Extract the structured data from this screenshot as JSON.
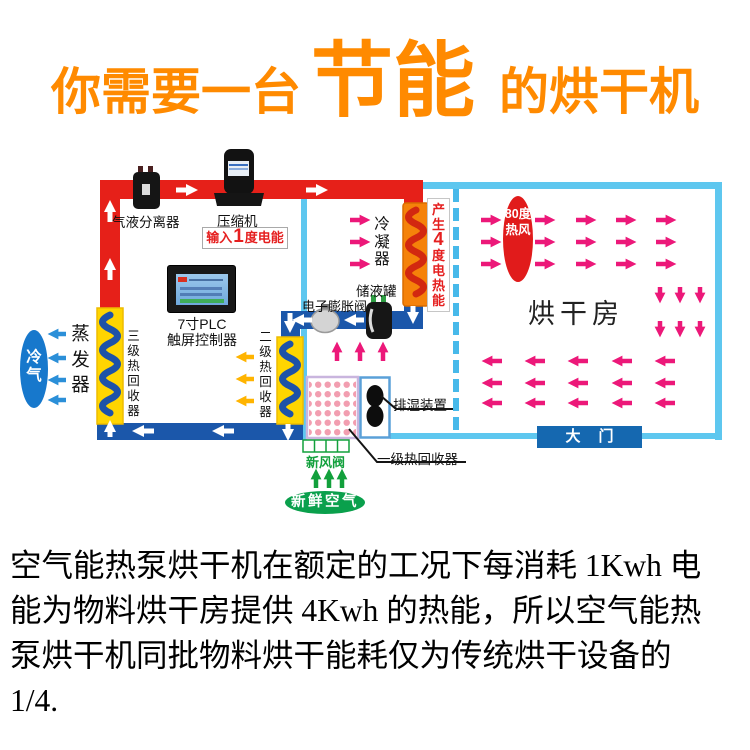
{
  "title": {
    "prefix": "你需要一台",
    "highlight": "节能",
    "suffix": "的烘干机"
  },
  "diagram": {
    "separator_label": "气液分离器",
    "compressor_label": "压缩机",
    "input_energy": {
      "pre": "输入",
      "value": "1",
      "post": "度电能"
    },
    "condenser_label": "冷凝器",
    "output_energy": {
      "pre": "产生",
      "value": "4",
      "post": "度电热能"
    },
    "hot_air_badge": "80度热风",
    "drying_room_label": "烘干房",
    "door_label": "大门",
    "plc_label_line1": "7寸PLC",
    "plc_label_line2": "触屏控制器",
    "tank_label": "储液罐",
    "valve_label": "电子膨胀阀",
    "stage3_recovery_label": "三级热回收器",
    "stage2_recovery_label": "二级热回收器",
    "stage1_recovery_label": "一级热回收器",
    "evaporator_label": "蒸发器",
    "cold_air_badge": "冷气",
    "exhaust_label": "排湿装置",
    "fresh_air_valve_label": "新风阀",
    "fresh_air_badge": "新鲜空气"
  },
  "description": "空气能热泵烘干机在额定的工况下每消耗 1Kwh 电能为物料烘干房提供 4Kwh 的热能，所以空气能热泵烘干机同批物料烘干能耗仅为传统烘干设备的1/4.",
  "colors": {
    "title_orange": "#ff8a00",
    "hot_pipe_red": "#e62019",
    "cold_pipe_blue": "#1b57aa",
    "wall_light_blue": "#5ec7ef",
    "coil_yellow": "#ffd500",
    "condenser_orange": "#f5820a",
    "airflow_pink": "#ec1879",
    "fresh_green": "#0aa04c",
    "door_blue": "#1568b0",
    "hot_badge_red": "#e11b1b",
    "cold_badge_blue": "#1778cc"
  }
}
